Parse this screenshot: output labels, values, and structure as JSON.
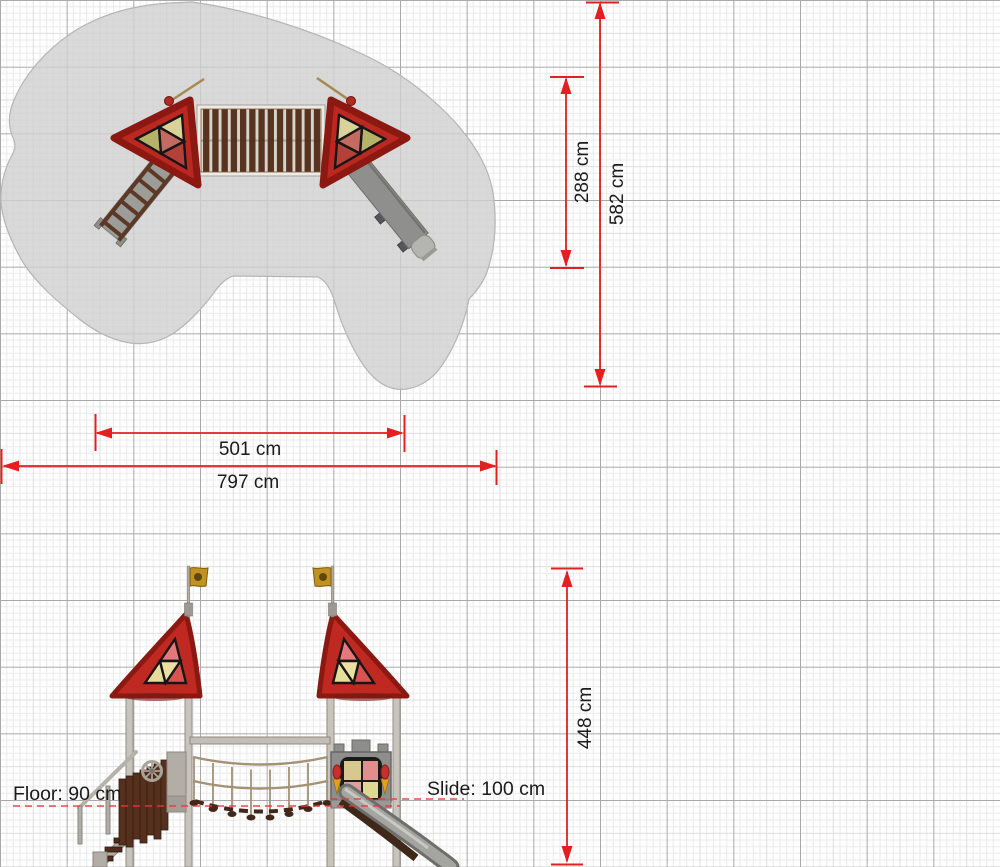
{
  "drawing": {
    "title": "playground-equipment-dimension-drawing",
    "views": {
      "top": "top-plan-view",
      "front": "front-elevation-view"
    }
  },
  "dimensions": {
    "inner_depth": {
      "label": "288 cm"
    },
    "total_depth": {
      "label": "582 cm"
    },
    "inner_width": {
      "label": "501 cm"
    },
    "total_width": {
      "label": "797 cm"
    },
    "height": {
      "label": "448 cm"
    }
  },
  "annotations": {
    "floor": {
      "label": "Floor: 90 cm"
    },
    "slide": {
      "label": "Slide: 100 cm"
    }
  },
  "colors": {
    "dimension_red": "#e41f1f",
    "safety_zone_gray": "#d2d2d2",
    "roof_red": "#bf2922",
    "roof_edge_dark_red": "#8c1812",
    "bridge_wood_brown": "#58331f",
    "wood_dark_brown": "#4e2b1a",
    "steel_gray": "#c8c4bb",
    "slide_gray": "#9e9e9c",
    "rope_tan": "#a39276",
    "flag_gold": "#c29220",
    "pane_yellow": "#e6dd9a",
    "pane_pink": "#e57878",
    "pane_red": "#d95353",
    "pane_cream": "#ecdf9f",
    "pane_green": "#b7b269",
    "grid_major_gray": "#a9a9a9",
    "grid_fine_gray": "#ebebeb"
  }
}
